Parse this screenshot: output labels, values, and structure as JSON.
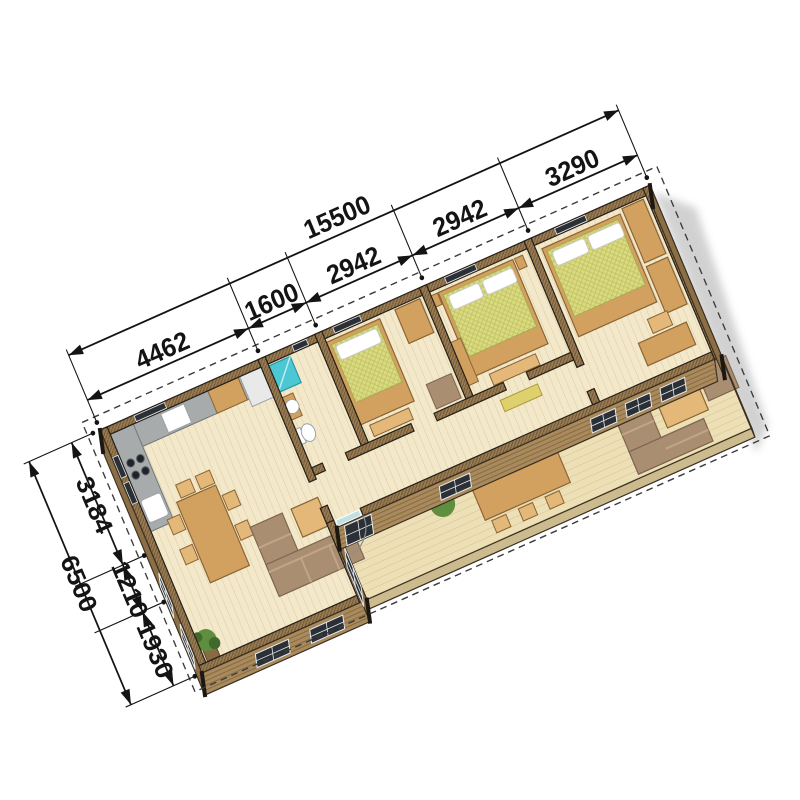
{
  "title": "isometric-floor-plan",
  "dimensions": {
    "unit": "mm",
    "top": {
      "total": "15500",
      "segments": [
        "4462",
        "1600",
        "2942",
        "2942",
        "3290"
      ]
    },
    "left": {
      "total": "6500",
      "segments": [
        "3184",
        "1210",
        "1930"
      ]
    }
  },
  "rooms": {
    "living_kitchen": "open plan kitchen / living room",
    "bathroom": "shower room",
    "bedroom_1": "bedroom",
    "bedroom_2": "bedroom",
    "bedroom_3": "bedroom",
    "hallway": "hallway",
    "terrace": "covered terrace deck"
  },
  "colors": {
    "floor": "#f3e8c9",
    "floorLine": "#d9cba2",
    "deck": "#eee0b6",
    "deckLine": "#d2c191",
    "wall": "#9a7c52",
    "wallLine": "#6f5636",
    "wallEdge": "#241f18",
    "face": "#a98a5d",
    "faceStripe": "#876a42",
    "faceEdge": "#3a2f20",
    "window": "#2a3036",
    "windowFrame": "#e8ebee",
    "bed": "#dadb80",
    "bedLine": "#c0c163",
    "pillow": "#ffffff",
    "wood": "#d2a05f",
    "woodEdge": "#8a6434",
    "woodLight": "#e3b878",
    "sofa": "#a98e72",
    "sofaEdge": "#7d6650",
    "cushion": "#c2a587",
    "shower": "#4cc7d4",
    "showerEdge": "#2b98a6",
    "fixture": "#ffffff",
    "fixtureEdge": "#9aa2a6",
    "plant": "#5d8f3f",
    "plantDark": "#41692c",
    "planter": "#8a6a42",
    "counter": "#a7abab",
    "counterEdge": "#70767a",
    "fridge": "#e9e9e9",
    "bench": "#ddd06d",
    "dim": "#141414",
    "dash": "#3c3c3c",
    "shadow": "#8f8f8f"
  }
}
